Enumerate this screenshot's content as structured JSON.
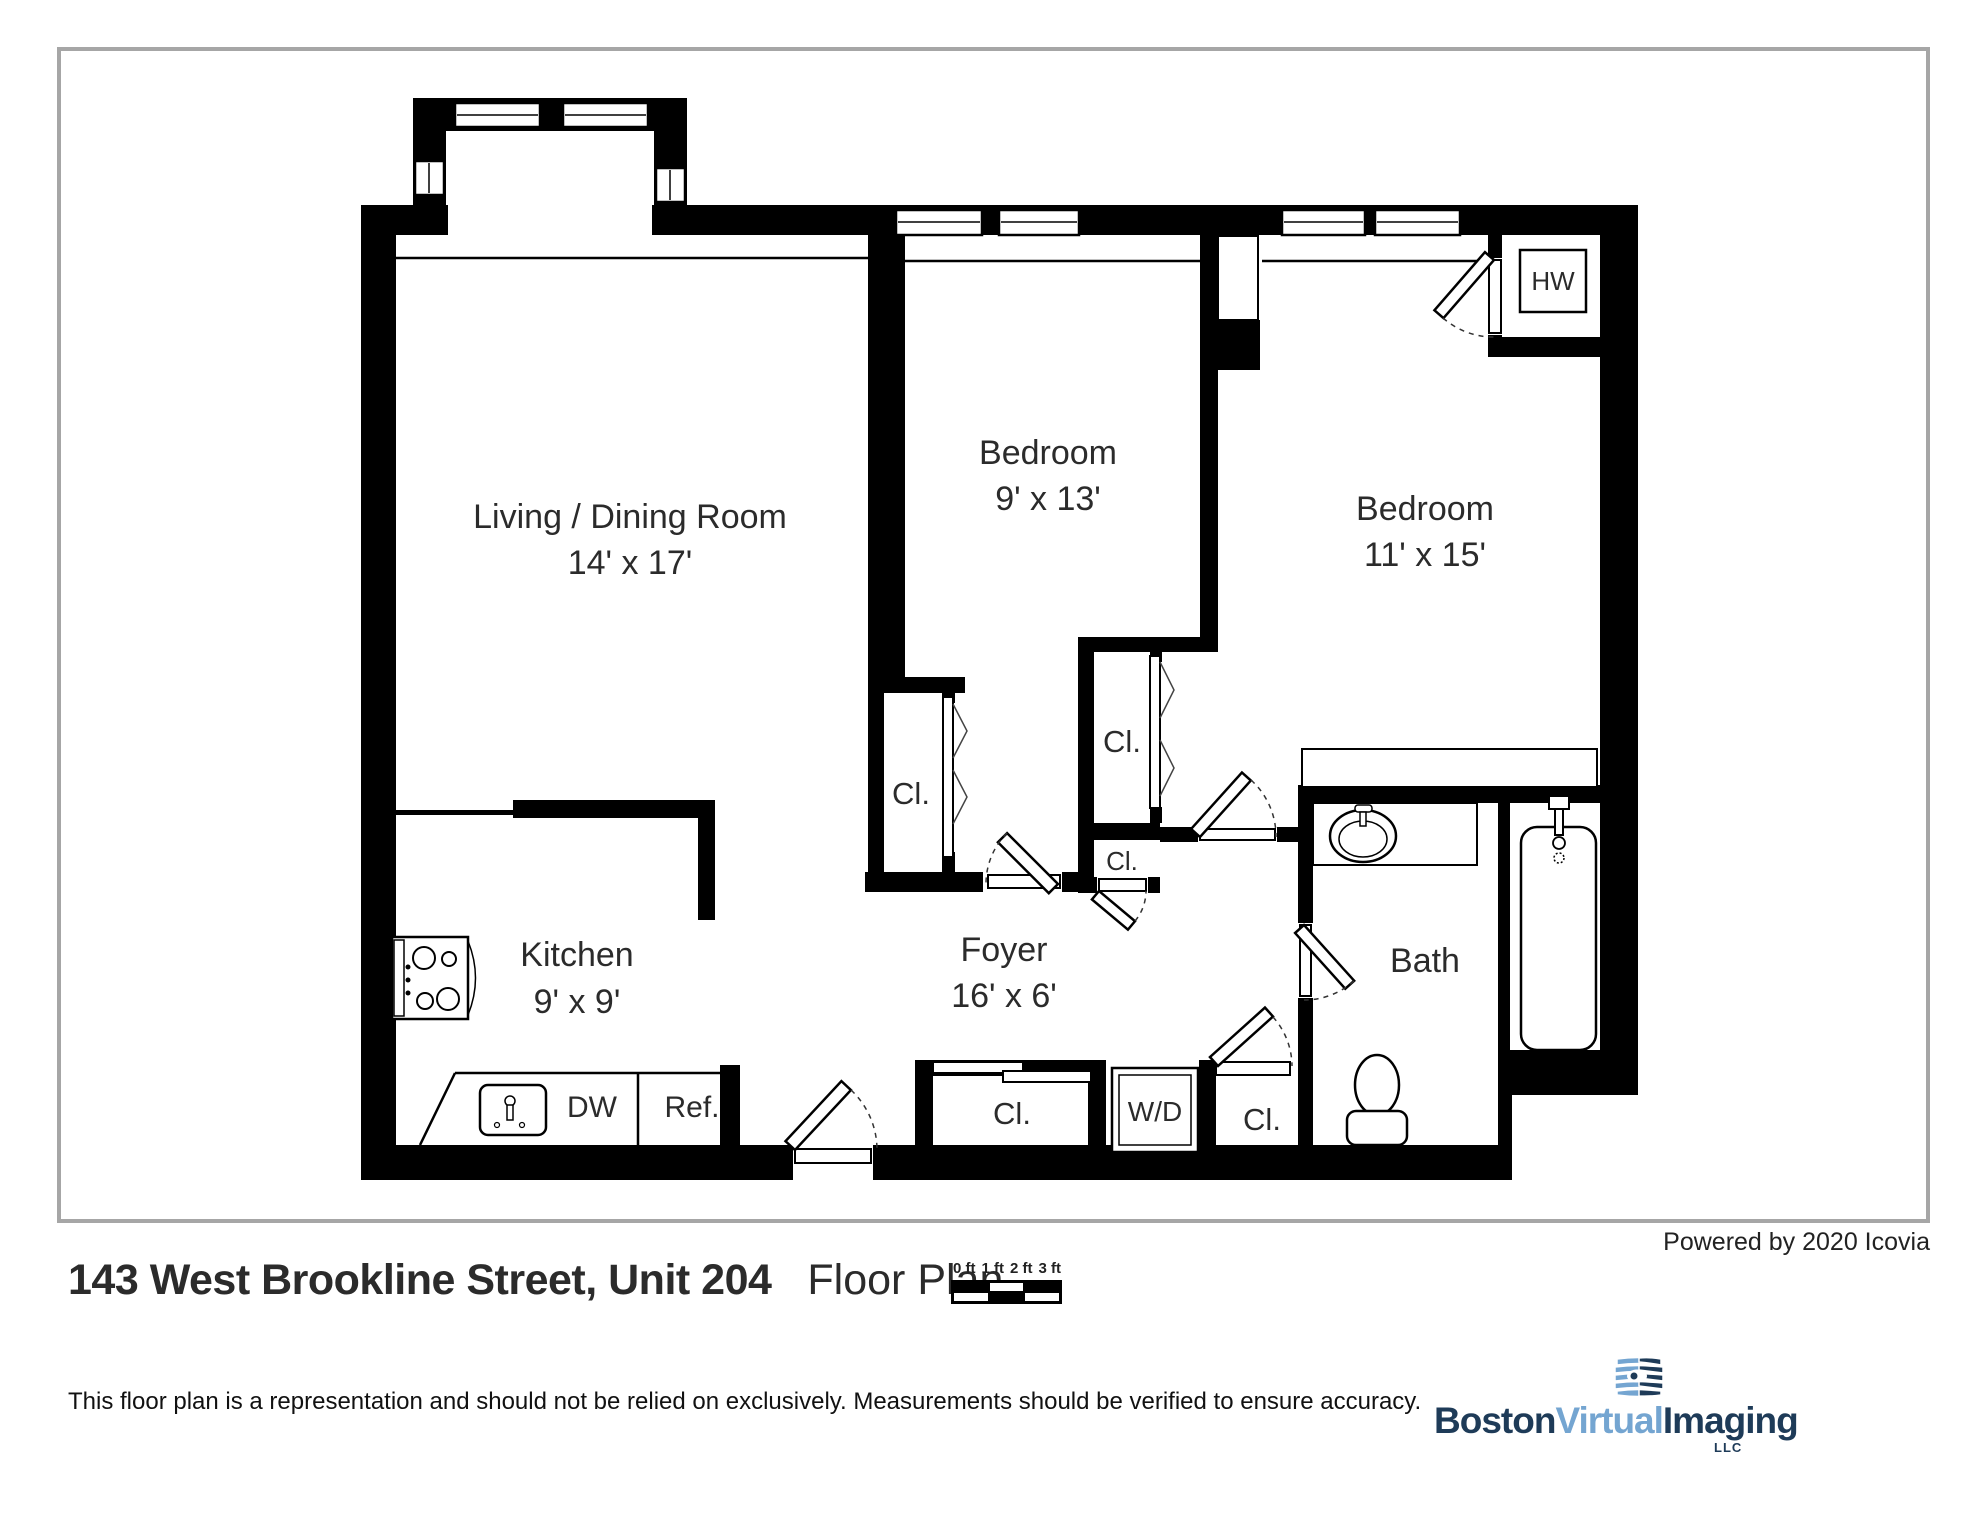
{
  "footer": {
    "powered_by": "Powered by 2020 Icovia",
    "title": "143 West Brookline Street, Unit 204",
    "subtitle": "Floor Plan",
    "disclaimer": "This floor plan is a representation and should not be relied on exclusively. Measurements should be verified to ensure accuracy.",
    "scale_bar": {
      "labels": [
        "0 ft",
        "1 ft",
        "2 ft",
        "3 ft"
      ]
    },
    "logo": {
      "word1": "Boston",
      "word2": "Virtual",
      "word3": "Imaging",
      "suffix": "LLC",
      "navy": "#1e3b58",
      "blue": "#74a5d1"
    }
  },
  "rooms": {
    "living": {
      "name": "Living / Dining Room",
      "dims": "14' x 17'"
    },
    "bedroom1": {
      "name": "Bedroom",
      "dims": "9' x 13'"
    },
    "bedroom2": {
      "name": "Bedroom",
      "dims": "11' x 15'"
    },
    "kitchen": {
      "name": "Kitchen",
      "dims": "9' x 9'"
    },
    "foyer": {
      "name": "Foyer",
      "dims": "16' x 6'"
    },
    "bath": {
      "name": "Bath"
    }
  },
  "fixtures": {
    "closet": "Cl.",
    "washer_dryer": "W/D",
    "dishwasher": "DW",
    "refrigerator": "Ref.",
    "hot_water_heater": "HW"
  },
  "colors": {
    "wall": "#000000",
    "frame_border": "#a6a6a6",
    "floor": "#ffffff"
  }
}
